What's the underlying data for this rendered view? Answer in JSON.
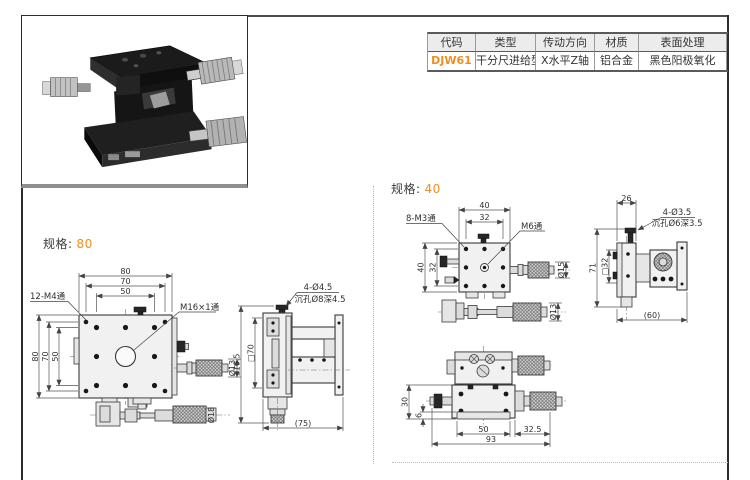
{
  "accent_color": "#ef8e1e",
  "spec_table": {
    "headers": [
      "代码",
      "类型",
      "传动方向",
      "材质",
      "表面处理"
    ],
    "row": {
      "code": "DJW61",
      "type": "干分尺进给型",
      "direction": "X水平Z轴",
      "material": "铝合金",
      "finish": "黑色阳极氧化"
    }
  },
  "spec80": {
    "heading_label": "规格:",
    "heading_value": "80",
    "front": {
      "dim_top": [
        "80",
        "70",
        "50"
      ],
      "dim_left": [
        "80",
        "70",
        "50"
      ],
      "holes_label": "12-M4通",
      "center_label": "M16×1通",
      "spindle_dia": "Ø13",
      "thimble_dia": "Ø18"
    },
    "side": {
      "holes_label": "4-Ø4.5",
      "counterbore_label": "沉孔Ø8深4.5",
      "height": "116.5",
      "square": "□70",
      "depth": "(75)"
    }
  },
  "spec40": {
    "heading_label": "规格:",
    "heading_value": "40",
    "front": {
      "dim_top": [
        "40",
        "32"
      ],
      "dim_left": [
        "40",
        "32"
      ],
      "holes_label": "8-M3通",
      "center_label": "M6通",
      "spindle_dia": "Ø15",
      "thimble_dia": "Ø13"
    },
    "side": {
      "width": "26",
      "holes_label": "4-Ø3.5",
      "counterbore_label": "沉孔Ø6深3.5",
      "height": "71",
      "square": "□32",
      "depth": "(60)"
    },
    "bottom": {
      "height": "30",
      "plate_thickness": "6",
      "inner_width": "50",
      "offset": "32.5",
      "total_width": "93"
    }
  }
}
